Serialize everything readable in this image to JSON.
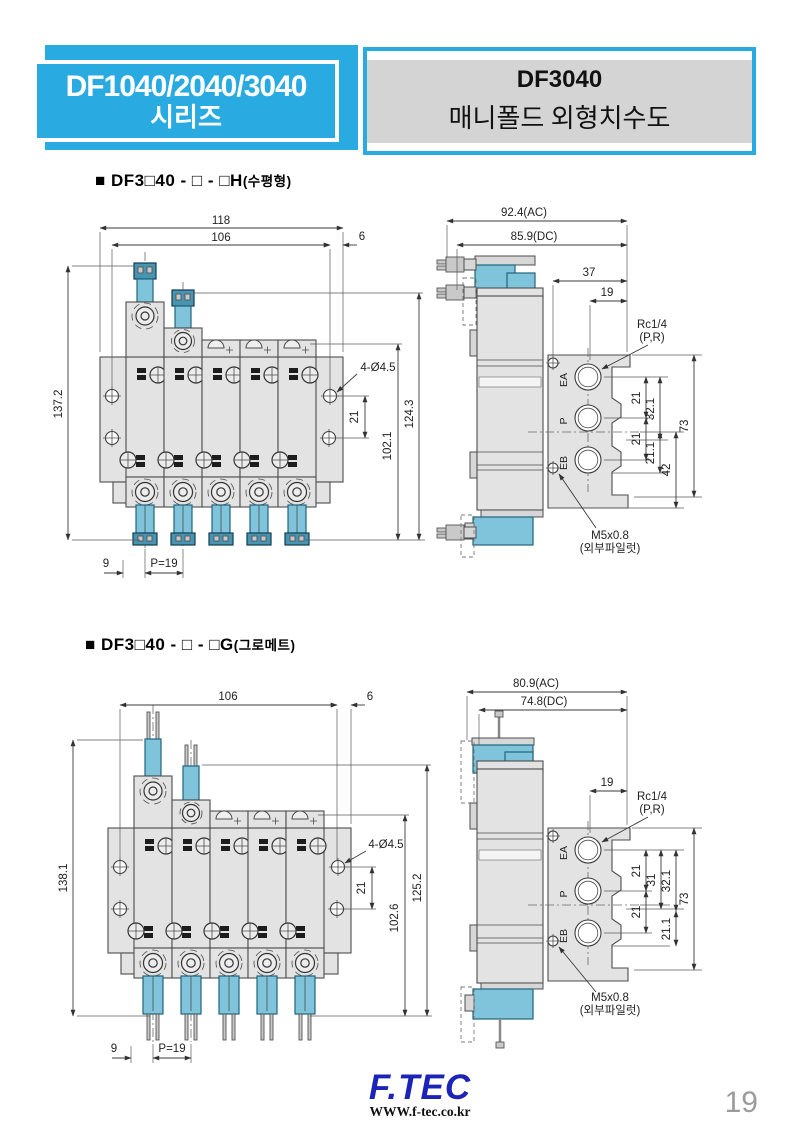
{
  "header": {
    "series_title_line1": "DF1040/2040/3040",
    "series_title_line2": "시리즈",
    "model": "DF3040",
    "doc_title": "매니폴드 외형치수도"
  },
  "section1": {
    "title": "■ DF3□40 - □ - □H",
    "title_note": "(수평형)",
    "front": {
      "dim_total_width": "118",
      "dim_inner_width": "106",
      "dim_end_width": "6",
      "dim_total_height": "137.2",
      "dim_height_outer": "124.3",
      "dim_height_inner": "102.1",
      "dim_hole_pitch": "21",
      "label_holes": "4-Ø4.5",
      "dim_offset": "9",
      "dim_pitch": "P=19"
    },
    "side": {
      "dim_width_ac": "92.4(AC)",
      "dim_width_dc": "85.9(DC)",
      "dim_37": "37",
      "dim_19": "19",
      "label_port": "Rc1/4",
      "label_port_note": "(P,R)",
      "port_ea": "EA",
      "port_p": "P",
      "port_eb": "EB",
      "dim_21_top": "21",
      "dim_32_1": "32.1",
      "dim_21_bottom": "21",
      "dim_21_1": "21.1",
      "dim_42": "42",
      "dim_73": "73",
      "label_pilot": "M5x0.8",
      "label_pilot_note": "(외부파일럿)"
    }
  },
  "section2": {
    "title": "■ DF3□40 - □ - □G",
    "title_note": "(그로메트)",
    "front": {
      "dim_inner_width": "106",
      "dim_end_width": "6",
      "dim_total_height": "138.1",
      "dim_height_outer": "125.2",
      "dim_height_inner": "102.6",
      "dim_hole_pitch": "21",
      "label_holes": "4-Ø4.5",
      "dim_offset": "9",
      "dim_pitch": "P=19"
    },
    "side": {
      "dim_width_ac": "80.9(AC)",
      "dim_width_dc": "74.8(DC)",
      "dim_19": "19",
      "label_port": "Rc1/4",
      "label_port_note": "(P,R)",
      "port_ea": "EA",
      "port_p": "P",
      "port_eb": "EB",
      "dim_21_top": "21",
      "dim_31": "31",
      "dim_32_1": "32.1",
      "dim_21_bottom": "21",
      "dim_21_1": "21.1",
      "dim_73": "73",
      "label_pilot": "M5x0.8",
      "label_pilot_note": "(외부파일럿)"
    }
  },
  "footer": {
    "logo_text": "F.TEC",
    "website": "WWW.f-tec.co.kr",
    "page_number": "19"
  },
  "colors": {
    "accent_cyan": "#29abe2",
    "solenoid_blue": "#7fc4da",
    "body_gray": "#e3e3e3",
    "header_band_gray": "#d4d4d4",
    "logo_blue": "#1c24b8",
    "page_number_gray": "#9b9b9b"
  }
}
